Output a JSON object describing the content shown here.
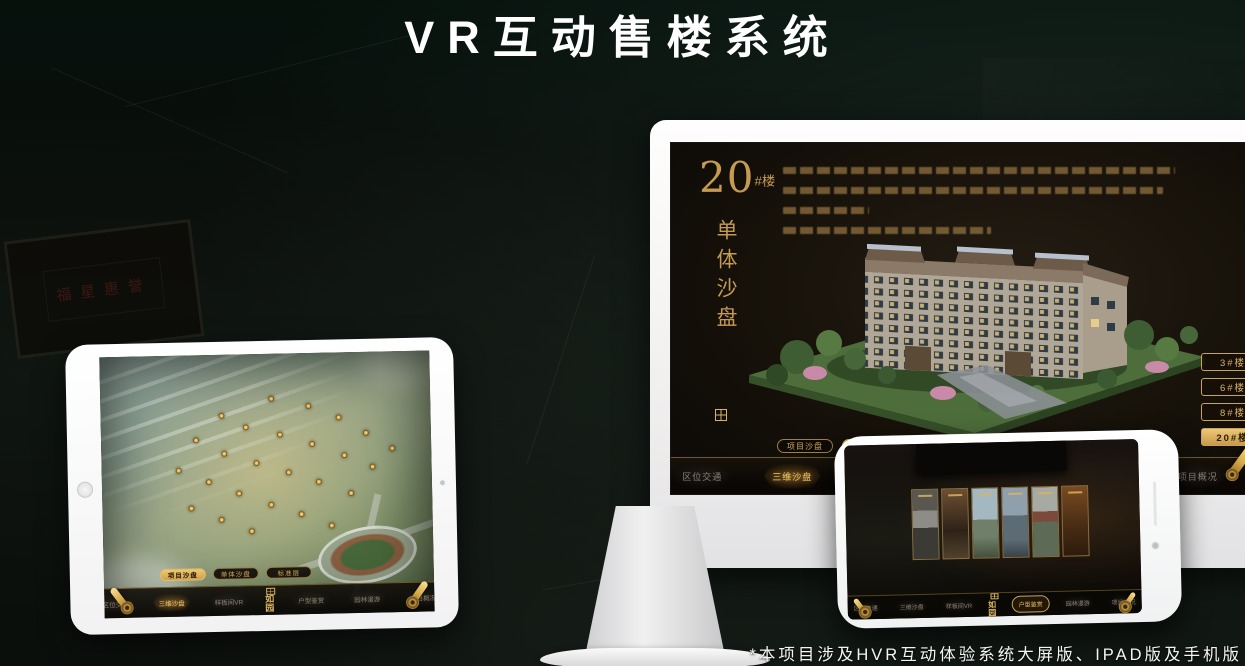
{
  "header": {
    "title": "VR互动售楼系统"
  },
  "footer": {
    "note": "*本项目涉及HVR互动体验系统大屏版、IPAD版及手机版"
  },
  "background": {
    "plaque_text": "福星惠誉"
  },
  "brand": {
    "logo_text": "如园"
  },
  "colors": {
    "gold": "#d4aa5e",
    "gold_active_bg": "#e3bc6a",
    "screen_dark": "#12100b",
    "nav_text_dim": "#8b8170",
    "title_white": "#ffffff"
  },
  "monitor_app": {
    "building_label": {
      "number": "20",
      "suffix": "#楼"
    },
    "section_title_vertical": "单体沙盘",
    "floor_buttons": [
      {
        "label": "3#楼",
        "active": false
      },
      {
        "label": "6#楼",
        "active": false
      },
      {
        "label": "8#楼",
        "active": false
      },
      {
        "label": "20#楼",
        "active": true
      }
    ],
    "sub_tabs": [
      {
        "label": "项目沙盘",
        "active": false
      },
      {
        "label": "单体沙盘",
        "active": true
      },
      {
        "label": "标准层",
        "active": false
      }
    ],
    "nav_left": [
      "区位交通",
      "三维沙盘",
      "样板间VR"
    ],
    "nav_right": [
      "户型鉴赏",
      "园林漫游",
      "项目概况"
    ],
    "nav_active": "三维沙盘"
  },
  "tablet_app": {
    "sub_tabs": [
      {
        "label": "项目沙盘",
        "active": true
      },
      {
        "label": "单体沙盘",
        "active": false
      },
      {
        "label": "标准层",
        "active": false
      }
    ],
    "nav_left": [
      "区位交通",
      "三维沙盘",
      "样板间VR"
    ],
    "nav_right": [
      "户型鉴赏",
      "园林漫游",
      "项目概况"
    ],
    "nav_active": "三维沙盘"
  },
  "phone_app": {
    "nav_left": [
      "区位交通",
      "三维沙盘",
      "样板间VR"
    ],
    "nav_right": [
      "户型鉴赏",
      "园林漫游",
      "项目概况"
    ],
    "nav_active": "户型鉴赏"
  }
}
